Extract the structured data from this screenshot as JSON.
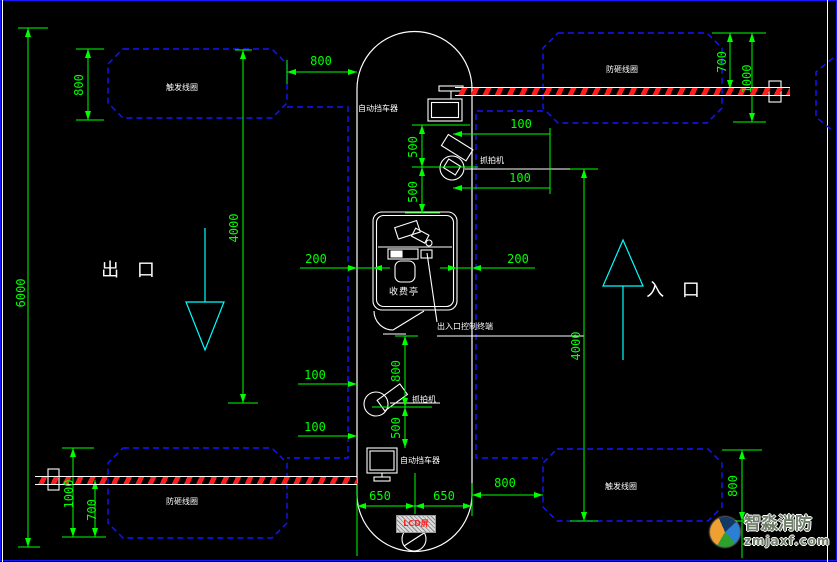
{
  "drawing": {
    "labels": {
      "coil_trigger": "触发线圈",
      "coil_anti_smash": "防砸线圈",
      "auto_barrier": "自动挡车器",
      "capture_camera": "抓拍机",
      "toll_booth": "收费亭",
      "control_terminal": "出入口控制终端",
      "exit": "出 口",
      "entrance": "入 口",
      "stamp": "LCD屏"
    },
    "dimensions": {
      "d6000": "6000",
      "d4000": "4000",
      "d1000": "1000",
      "d800": "800",
      "d700": "700",
      "d650": "650",
      "d500": "500",
      "d200": "200",
      "d100": "100"
    },
    "watermark": {
      "brand": "智淼消防",
      "site": "zmjaxf.com"
    },
    "colors": {
      "dimension": "#00ff00",
      "coil": "#1515ff",
      "outline": "#ffffff",
      "direction_arrow": "#00ffff",
      "barrier_stripe": "#ff1e1e",
      "stamp_text": "#ff2020"
    }
  }
}
